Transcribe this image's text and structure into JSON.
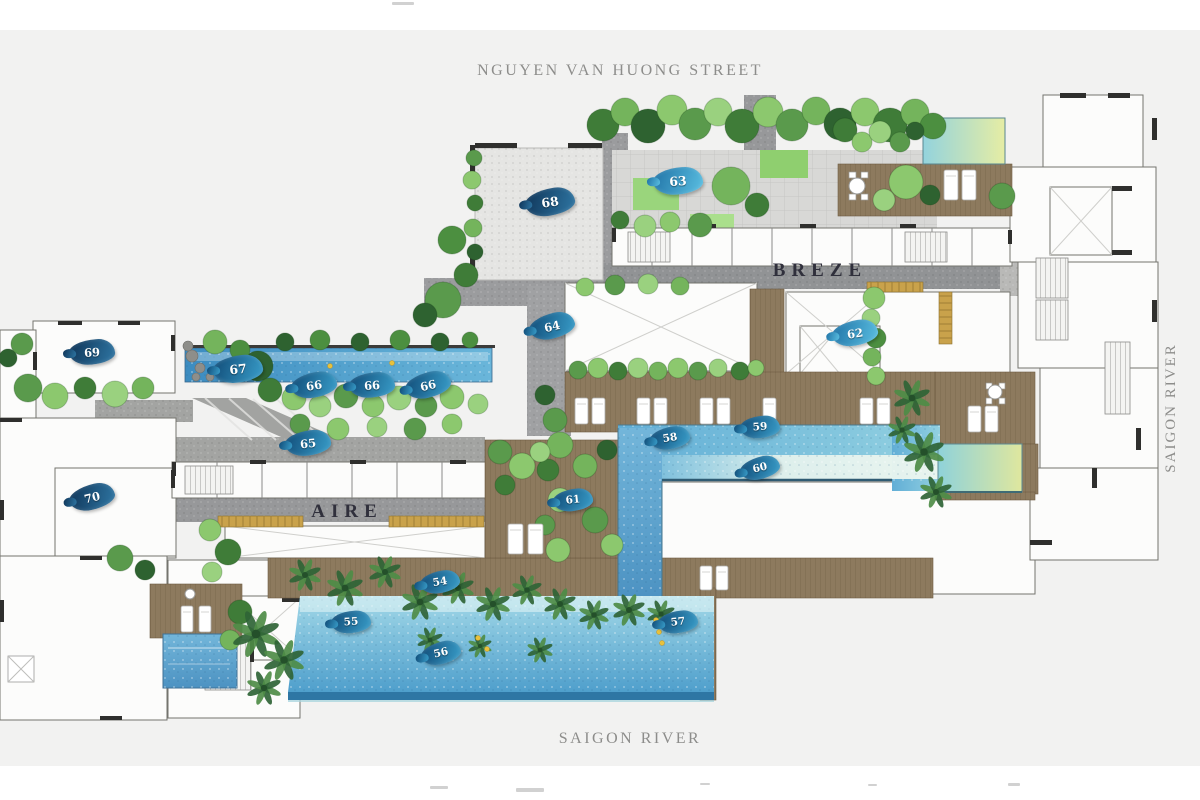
{
  "plan": {
    "street_label": "NGUYEN VAN HUONG STREET",
    "river_label_right": "SAIGON RIVER",
    "river_label_bottom": "SAIGON RIVER",
    "tower_labels": {
      "breze": "BREZE",
      "aire": "AIRE"
    },
    "colors": {
      "background": "#f2f2f1",
      "marker_dark": "#16436a",
      "marker_mid": "#1a5f8e",
      "marker_light": "#2f8fbc",
      "pool_blue": "#5aa9d2",
      "pool_green_tint": "#dfe79e",
      "deck_wood": "#8d7a5e",
      "paving_gray": "#98999b",
      "landscape_green": "#5a9a4c"
    },
    "markers": [
      {
        "label": "54",
        "x": 440,
        "y": 582,
        "tone": "mid",
        "size": "sm"
      },
      {
        "label": "55",
        "x": 351,
        "y": 622,
        "tone": "mid",
        "size": "sm"
      },
      {
        "label": "56",
        "x": 441,
        "y": 653,
        "tone": "mid",
        "size": "sm"
      },
      {
        "label": "57",
        "x": 678,
        "y": 622,
        "tone": "mid",
        "size": "sm"
      },
      {
        "label": "58",
        "x": 670,
        "y": 438,
        "tone": "mid",
        "size": "sm"
      },
      {
        "label": "59",
        "x": 760,
        "y": 427,
        "tone": "mid",
        "size": "sm"
      },
      {
        "label": "60",
        "x": 760,
        "y": 468,
        "tone": "mid",
        "size": "sm"
      },
      {
        "label": "61",
        "x": 573,
        "y": 500,
        "tone": "mid",
        "size": "sm"
      },
      {
        "label": "62",
        "x": 855,
        "y": 333,
        "tone": "light",
        "size": "md"
      },
      {
        "label": "63",
        "x": 678,
        "y": 181,
        "tone": "light",
        "size": "lg"
      },
      {
        "label": "64",
        "x": 552,
        "y": 326,
        "tone": "mid",
        "size": "md"
      },
      {
        "label": "65",
        "x": 308,
        "y": 443,
        "tone": "mid",
        "size": "md"
      },
      {
        "label": "66",
        "x": 314,
        "y": 385,
        "tone": "mid",
        "size": "md"
      },
      {
        "label": "66",
        "x": 372,
        "y": 385,
        "tone": "mid",
        "size": "md"
      },
      {
        "label": "66",
        "x": 428,
        "y": 385,
        "tone": "mid",
        "size": "md"
      },
      {
        "label": "67",
        "x": 238,
        "y": 369,
        "tone": "mid",
        "size": "lg"
      },
      {
        "label": "68",
        "x": 550,
        "y": 202,
        "tone": "dark",
        "size": "lg"
      },
      {
        "label": "69",
        "x": 92,
        "y": 352,
        "tone": "dark",
        "size": "md"
      },
      {
        "label": "70",
        "x": 92,
        "y": 497,
        "tone": "dark",
        "size": "md"
      }
    ]
  }
}
